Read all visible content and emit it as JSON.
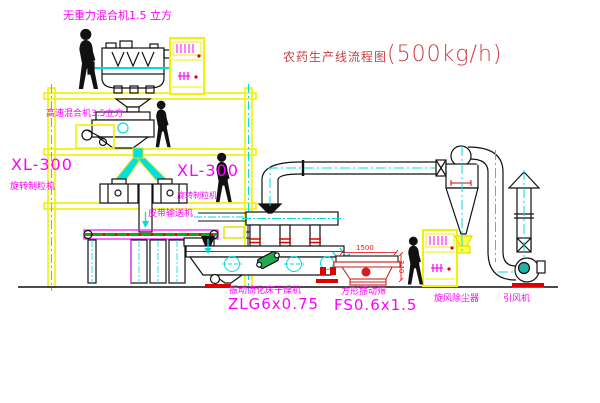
{
  "title": {
    "name": "农药生产线流程图",
    "capacity": "(500kg/h)"
  },
  "labels": {
    "gravity_mixer": "无重力混合机1.5 立方",
    "high_speed_mixer": "高速混合机3.5立方",
    "granulator_model_left": "XL-300",
    "granulator_name_left": "旋转制粒机",
    "granulator_model_right": "XL-300",
    "granulator_name_right": "旋转制粒机",
    "belt_conveyor": "皮带输送机",
    "fluid_bed_dryer": "振动流化床干燥机",
    "fluid_bed_dryer_model": "ZLG6x0.75",
    "square_sieve": "方形振动筛",
    "square_sieve_model": "FS0.6x1.5",
    "cyclone": "旋风除尘器",
    "induced_draft_fan": "引风机"
  },
  "dimensions": {
    "sieve_length": "1500",
    "sieve_height": "340"
  },
  "colors": {
    "structure_yellow": "#f2f200",
    "label_magenta": "#ff00ff",
    "title_red": "#c84040",
    "centerline_cyan": "#00dddd",
    "accent_red": "#dd0000",
    "conveyor_green": "#00b400",
    "motor_green": "#1faa50",
    "fan_teal": "#20b2aa"
  }
}
